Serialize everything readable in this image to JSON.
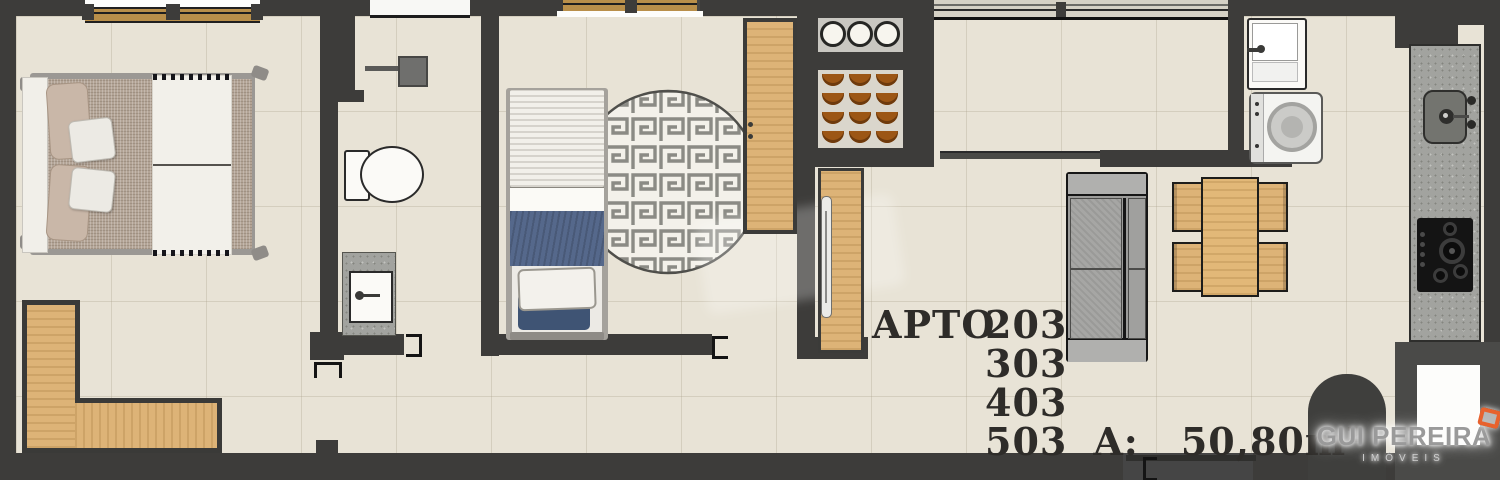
{
  "apartment": {
    "label": "APTO",
    "units": [
      "203",
      "303",
      "403",
      "503"
    ],
    "area_label": "A:",
    "area_value": "50,80m²"
  },
  "branding": {
    "agency_name": "GUI PEREIRA",
    "agency_tagline": "IMÓVEIS"
  },
  "colors": {
    "wall": "#3d3c3a",
    "floor_tile": "#e8e3d6",
    "wood": "#ddb377",
    "accent_orange": "#e8622d",
    "blanket_blue": "#55688b",
    "counter_granite": "#a2a39f",
    "bowl_brown": "#9c5615"
  },
  "furniture_items": [
    "double-bed",
    "l-shaped-wardrobe",
    "shower",
    "toilet",
    "bathroom-vanity",
    "single-bed",
    "round-meander-rug",
    "closet",
    "dish-shelf",
    "pantry-shelf",
    "tv-panel",
    "sofa",
    "dining-table",
    "dining-chairs",
    "laundry-tub",
    "washing-machine",
    "kitchen-counter",
    "kitchen-sink",
    "cooktop"
  ]
}
